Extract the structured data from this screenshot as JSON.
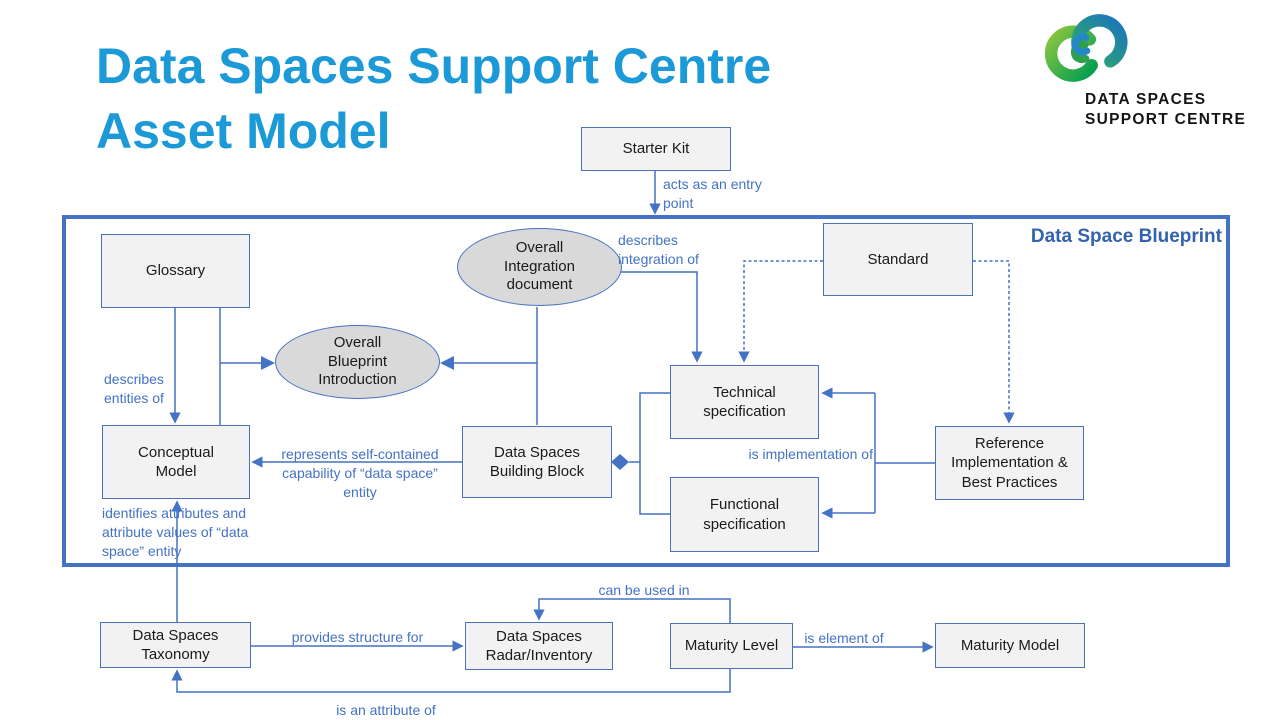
{
  "title": "Data Spaces Support Centre Asset Model",
  "logo": {
    "line1": "DATA SPACES",
    "line2": "SUPPORT CENTRE"
  },
  "blueprint": {
    "label": "Data Space Blueprint"
  },
  "nodes": {
    "starter_kit": "Starter Kit",
    "glossary": "Glossary",
    "overall_integration": "Overall Integration document",
    "standard": "Standard",
    "overall_blueprint_intro": "Overall Blueprint Introduction",
    "technical_spec": "Technical specification",
    "functional_spec": "Functional specification",
    "conceptual_model": "Conceptual Model",
    "building_block": "Data Spaces Building Block",
    "reference_impl": "Reference Implementation & Best Practices",
    "taxonomy": "Data Spaces Taxonomy",
    "radar": "Data Spaces Radar/Inventory",
    "maturity_level": "Maturity Level",
    "maturity_model": "Maturity Model"
  },
  "edges": {
    "acts_as_entry": "acts as an entry point",
    "describes_integration": "describes integration of",
    "describes_entities": "describes entities of",
    "represents": "represents self-contained capability of “data space” entity",
    "is_implementation": "is implementation of",
    "identifies": "identifies attributes and attribute values of “data space” entity",
    "provides_structure": "provides structure for",
    "can_be_used": "can be used in",
    "is_element": "is element of",
    "is_attribute": "is an attribute of"
  },
  "colors": {
    "title_blue": "#1b9ad7",
    "connector_blue": "#4472c4",
    "blueprint_border": "#4472c4",
    "blueprint_label": "#3263ae",
    "box_fill": "#f2f2f2",
    "box_border": "#4a72b4",
    "ellipse_fill": "#d9d9d9",
    "logo_green": "#8cc63f",
    "logo_dark_green": "#009e4f",
    "logo_blue": "#1b75bc"
  }
}
